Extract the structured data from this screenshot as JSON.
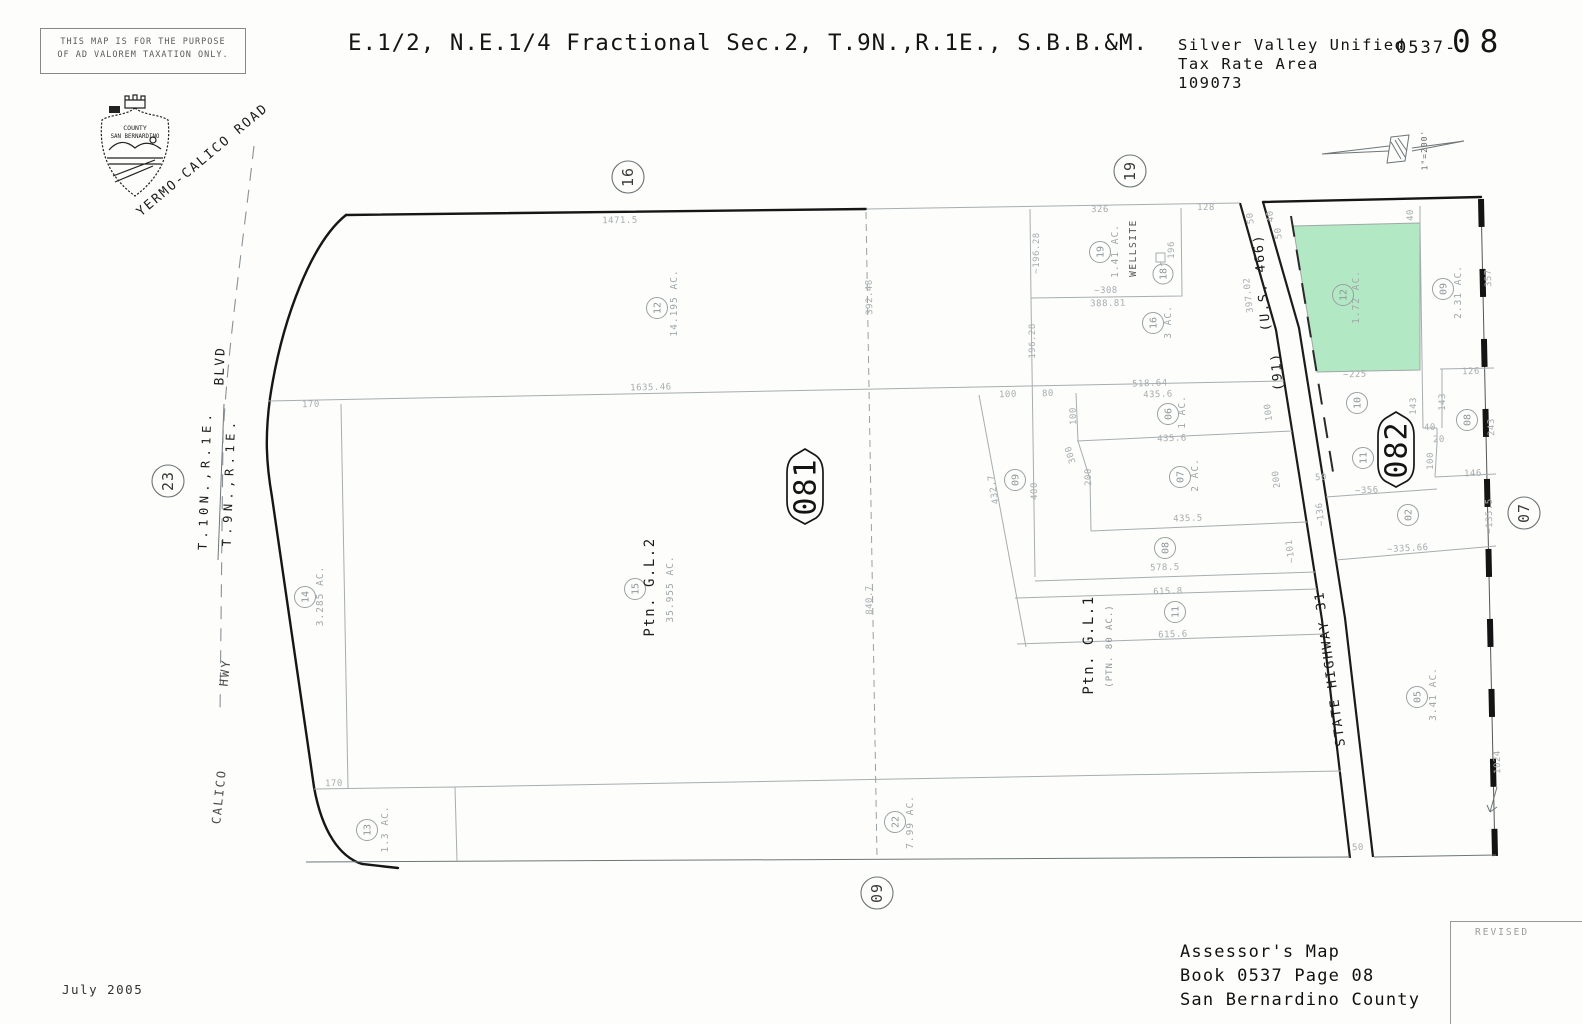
{
  "header": {
    "disclaimer_line1": "THIS MAP IS FOR THE PURPOSE",
    "disclaimer_line2": "OF AD VALOREM TAXATION ONLY.",
    "title": "E.1/2, N.E.1/4 Fractional Sec.2, T.9N.,R.1E., S.B.B.&M.",
    "district": "Silver Valley Unified",
    "tax_rate_area_label": "Tax Rate Area",
    "tax_rate_area_code": "109073",
    "book_prefix": "0537-",
    "page_number": "08",
    "scale_label": "1\"=200'"
  },
  "seal": {
    "line1": "COUNTY",
    "line2": "SAN BERNARDINO"
  },
  "roads": {
    "yermo_calico": "YERMO-CALICO  ROAD",
    "blvd": "BLVD",
    "hwy": "HWY",
    "calico": "CALICO",
    "us466": "(U.S. 466)",
    "r91": "(91)",
    "state_highway": "STATE  HIGHWAY  31"
  },
  "township": {
    "north": "T.10N.,R.1E.",
    "south": "T.9N.,R.1E."
  },
  "section_markers": [
    "23",
    "16",
    "19",
    "09",
    "07"
  ],
  "map_badges": [
    "081",
    "082"
  ],
  "parcels": [
    {
      "num": "12",
      "acres": "14.195 AC."
    },
    {
      "num": "19",
      "acres": "1.41 AC.",
      "note": "WELLSITE"
    },
    {
      "num": "18"
    },
    {
      "num": "16",
      "acres": "3 AC."
    },
    {
      "num": "06",
      "acres": "1 AC."
    },
    {
      "num": "07",
      "acres": "2 AC."
    },
    {
      "num": "08"
    },
    {
      "num": "09"
    },
    {
      "num": "11",
      "note": "Ptn. G.L.1",
      "note2": "(PTN. 80 AC.)"
    },
    {
      "num": "15",
      "note": "Ptn. G.L.2",
      "acres": "35.955 AC."
    },
    {
      "num": "14",
      "acres": "3.285 AC."
    },
    {
      "num": "13",
      "acres": "1.3 AC."
    },
    {
      "num": "22",
      "acres": "7.99 AC."
    },
    {
      "num": "12",
      "acres": "1.72 AC.",
      "highlighted": true
    },
    {
      "num": "09",
      "acres": "2.31 AC."
    },
    {
      "num": "10"
    },
    {
      "num": "08"
    },
    {
      "num": "11"
    },
    {
      "num": "02"
    },
    {
      "num": "05",
      "acres": "3.41 AC."
    }
  ],
  "dims": [
    "1471.5",
    "326",
    "128",
    "50",
    "40",
    "50",
    "40",
    "~196.28",
    "196",
    "~308",
    "388.81",
    "196.28",
    "392.48",
    "397.02",
    "1635.46",
    "170",
    "518.64",
    "100",
    "80",
    "435.6",
    "435.6",
    "435.5",
    "578.5",
    "615.8",
    "615.6",
    "100",
    "300",
    "200",
    "400",
    "432.7",
    "100",
    "200",
    "~101",
    "840.7",
    "~225",
    "126",
    "143",
    "143",
    "40",
    "20",
    "100",
    "146",
    "243",
    "357",
    "~356",
    "~136",
    "50",
    "~135.5",
    "~335.66",
    "1024",
    "50",
    "170"
  ],
  "footer": {
    "date": "July 2005",
    "assessor_line1": "Assessor's Map",
    "assessor_line2": "Book 0537 Page 08",
    "assessor_line3": "San Bernardino County",
    "revised_label": "REVISED"
  },
  "colors": {
    "highlight_green": "#b2e9c4"
  }
}
